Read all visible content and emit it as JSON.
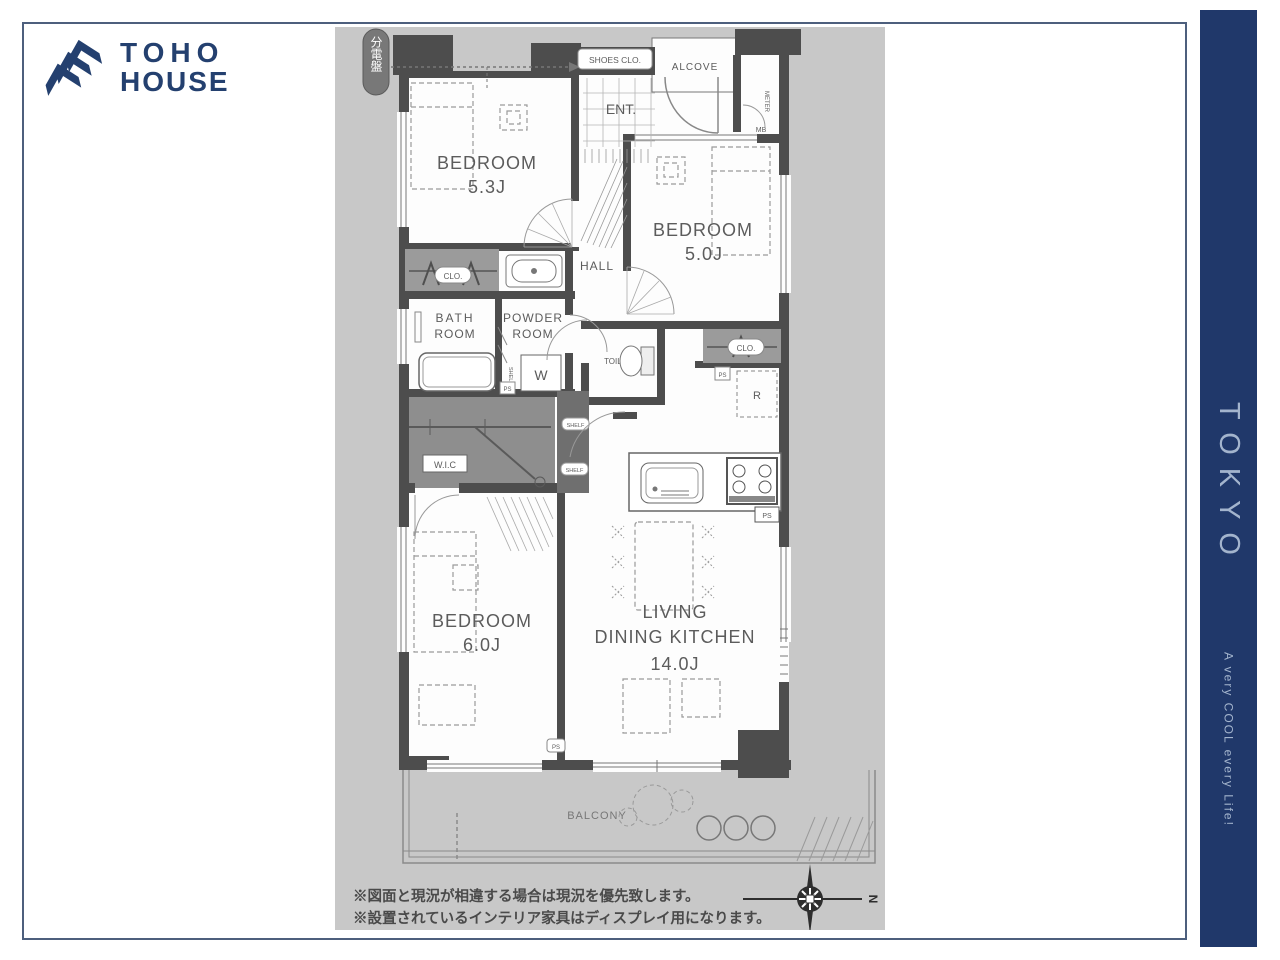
{
  "brand": {
    "line1": "TOHO",
    "line2": "HOUSE"
  },
  "sidebar": {
    "title": "TOKYO",
    "tagline": "A very COOL every Life!"
  },
  "plan": {
    "breaker_panel": "分電盤",
    "shoes_closet": "SHOES CLO.",
    "alcove": "ALCOVE",
    "entrance": "ENT.",
    "meter": "METER",
    "meter_box": "MB",
    "hall": "HALL",
    "bedroom1": {
      "label": "BEDROOM",
      "size": "5.3J"
    },
    "bedroom2": {
      "label": "BEDROOM",
      "size": "5.0J"
    },
    "bedroom3": {
      "label": "BEDROOM",
      "size": "6.0J"
    },
    "ldk": {
      "line1": "LIVING",
      "line2": "DINING KITCHEN",
      "size": "14.0J"
    },
    "bath": {
      "line1": "BATH",
      "line2": "ROOM"
    },
    "powder": {
      "line1": "POWDER",
      "line2": "ROOM"
    },
    "toilet": "TOILET",
    "washer": "W",
    "wic": "W.I.C",
    "closet1": "CLO.",
    "closet2": "CLO.",
    "shelf1": "SHELF",
    "shelf2": "SHELF",
    "shelf_side": "SHELF",
    "fridge": "R",
    "ps1": "PS",
    "ps2": "PS",
    "ps3": "PS",
    "ps4": "PS",
    "balcony": "BALCONY",
    "compass_north": "N"
  },
  "notes": {
    "line1": "※図面と現況が相違する場合は現況を優先致します。",
    "line2": "※設置されているインテリア家具はディスプレイ用になります。"
  },
  "colors": {
    "brand_navy": "#20386a",
    "panel_gray": "#c8c8c8",
    "wall_gray": "#4d4d4d"
  }
}
